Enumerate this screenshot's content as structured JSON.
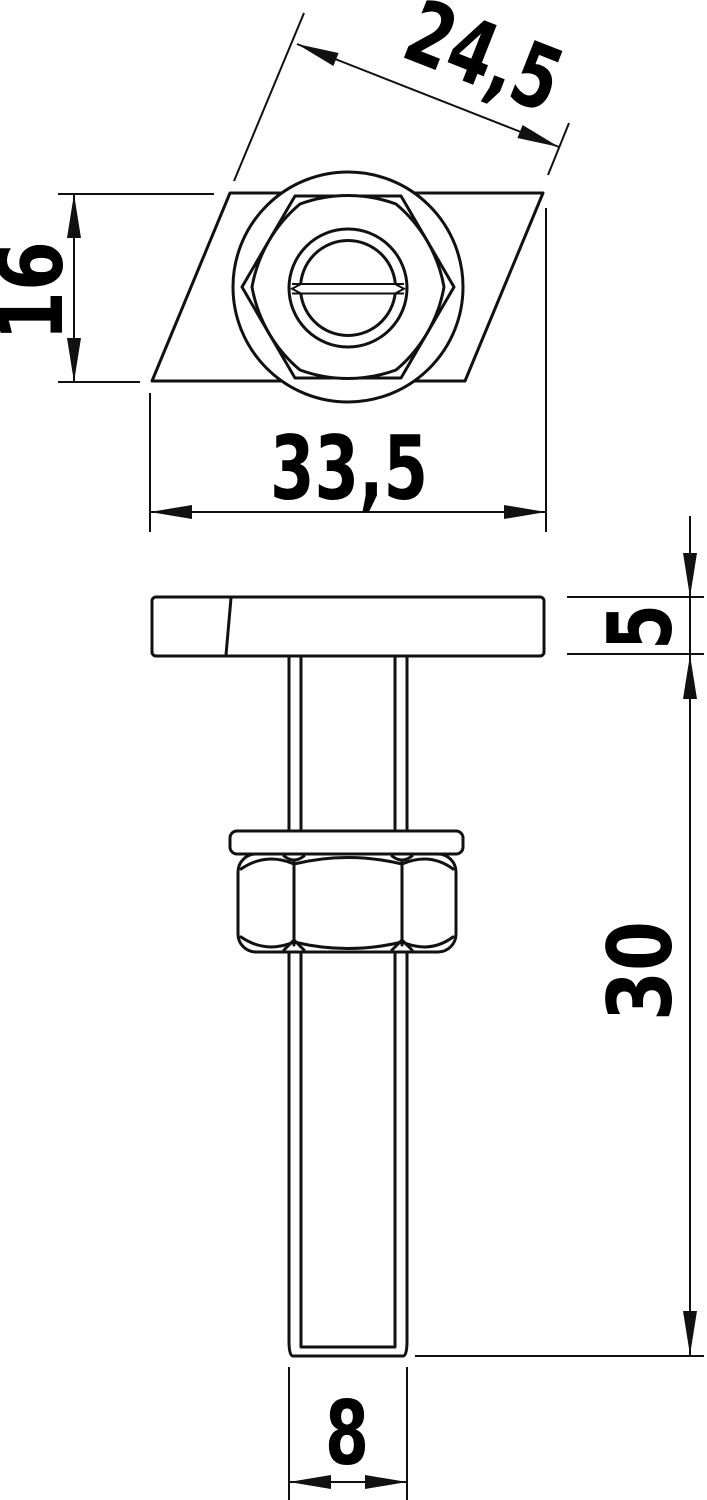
{
  "drawing": {
    "type": "technical-dimension-drawing",
    "background_color": "#ffffff",
    "line_color": "#111111",
    "top_view": {
      "dim_diagonal_width": "24,5",
      "dim_height": "16",
      "dim_width": "33,5"
    },
    "side_view": {
      "dim_plate_thickness": "5",
      "dim_bolt_length": "30",
      "dim_thread_diameter": "8"
    }
  }
}
